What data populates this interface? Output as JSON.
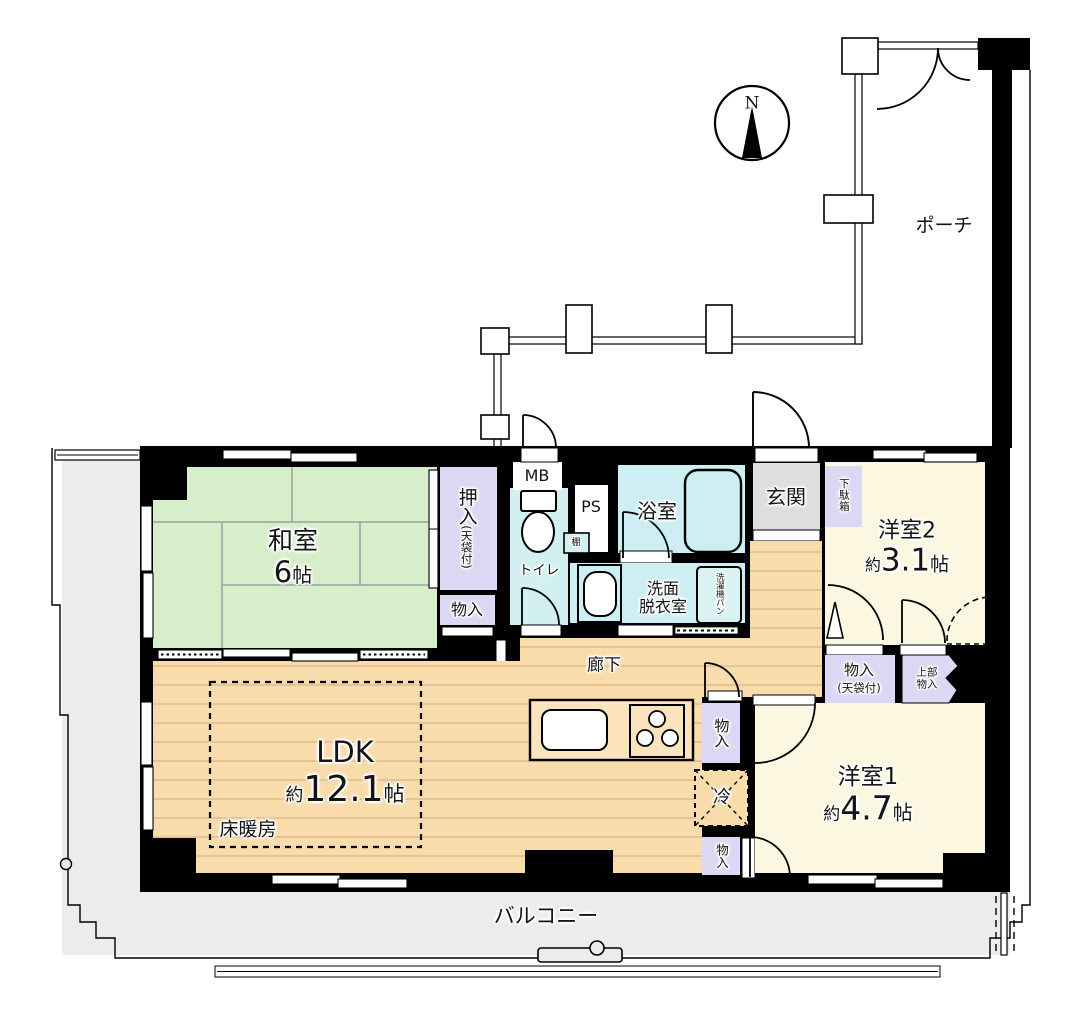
{
  "outdoor": {
    "compass_north": "N",
    "porch": "ポーチ",
    "balcony": "バルコニー"
  },
  "rooms": {
    "washitsu": {
      "name": "和室",
      "size_num": "6",
      "size_unit": "帖"
    },
    "ldk": {
      "name": "LDK",
      "approx": "約",
      "size_num": "12.1",
      "size_unit": "帖",
      "floor_heating": "床暖房"
    },
    "yoshitsu1": {
      "name": "洋室1",
      "approx": "約",
      "size_num": "4.7",
      "size_unit": "帖"
    },
    "yoshitsu2": {
      "name": "洋室2",
      "approx": "約",
      "size_num": "3.1",
      "size_unit": "帖"
    },
    "genkan": "玄関",
    "rouka": "廊下",
    "toilet": "トイレ",
    "bathroom": "浴室",
    "washroom_line1": "洗面",
    "washroom_line2": "脱衣室"
  },
  "storage": {
    "oshiire": "押入",
    "oshiire_note": "(天袋付)",
    "monoire_washitsu": "物入",
    "getabako": "下駄箱",
    "monoire_hall": "物入",
    "monoire_hall_note": "(天袋付)",
    "upper_storage_line1": "上部",
    "upper_storage_line2": "物入",
    "monoire_kitchen_upper": "物入",
    "monoire_kitchen_lower": "物入",
    "shelf": "棚"
  },
  "equipment": {
    "meter_box": "MB",
    "pipe_space": "PS",
    "fridge": "冷",
    "laundry_line1": "洗濯機",
    "laundry_line2": "パン"
  },
  "colors": {
    "wall_black": "#000000",
    "tatami_green": "#d7eecb",
    "wood_floor": "#f8dcab",
    "wood_line": "#dfbd8e",
    "western_room_cream": "#fbf7e0",
    "closet_purple": "#dcd7f2",
    "wet_area_cyan": "#cdeef2",
    "entrance_gray": "#dedede",
    "balcony_gray": "#ececec"
  }
}
